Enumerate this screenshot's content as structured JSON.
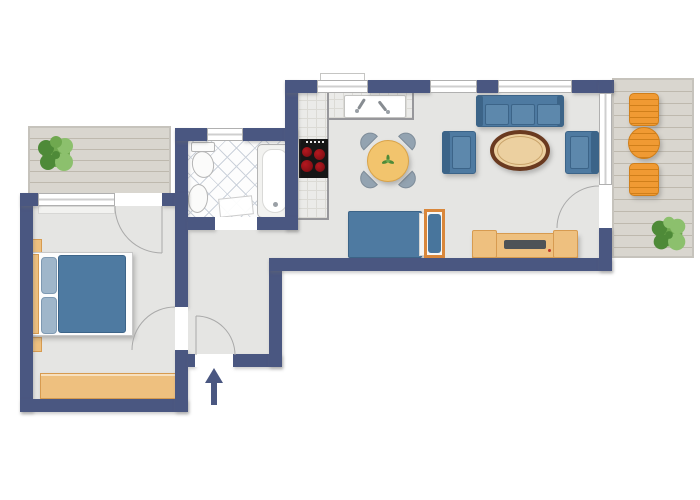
{
  "canvas": {
    "width": 700,
    "height": 500,
    "background": "#ffffff",
    "type": "apartment-floor-plan",
    "text_labels": []
  },
  "colors": {
    "wall": "#4a5781",
    "floor": "#e5e5e3",
    "tileBg": "#fdfdfd",
    "tileLine": "#ccd2db",
    "counter": "#ebebe9",
    "counterLine": "#dbdad5",
    "counterEdge": "#97979b",
    "deck": "#d9d6cf",
    "deckLine": "#beb9ae",
    "deckBorder": "#c6c3bc",
    "wood": "#eec07f",
    "woodEdge": "#d79b50",
    "frameOrange": "#d9873b",
    "blue": "#4e7aa1",
    "blueDark": "#3c6488",
    "cushion": "#5d88ac",
    "pillow": "#9fb6ca",
    "pillowDark": "#48759c",
    "orange": "#f09a33",
    "orangeDark": "#d07f1a",
    "stove": "#161616",
    "burner": "#8a1016",
    "outline": "#a9a9a9",
    "winFrame": "#b0b0b0",
    "winLine": "#cfcfcf",
    "white": "#ffffff",
    "fixture": "#fbfbfa",
    "fixtureEdge": "#b5b5b5",
    "plant1": "#4e8a38",
    "plant2": "#6fa84f",
    "plant3": "#8cc06d",
    "tableYellow": "#f2c46d",
    "tableYellowEdge": "#d9a348",
    "chairGray": "#93a3b1",
    "chairGrayEdge": "#7e8c99",
    "tableRim": "#6a3a20",
    "tableWood": "#ecd0a0",
    "tv": "#4e5357",
    "red": "#c0392b"
  },
  "rooms": [
    {
      "id": "balcony-left",
      "features": [
        "wood-deck",
        "potted-plant"
      ]
    },
    {
      "id": "bedroom",
      "features": [
        "double-bed",
        "two-pillows",
        "wardrobe",
        "window",
        "balcony-door",
        "hall-door"
      ]
    },
    {
      "id": "bathroom",
      "features": [
        "toilet",
        "washbasin",
        "bathtub",
        "window",
        "diagonal-tile-floor",
        "door"
      ]
    },
    {
      "id": "hall",
      "features": [
        "entrance-door",
        "entry-direction-arrow"
      ]
    },
    {
      "id": "living-room-kitchen",
      "features": [
        "kitchen-counter-L",
        "kitchen-sink",
        "stove-4-burners",
        "dining-table-round",
        "four-dining-chairs",
        "sofa-3-seat",
        "armchair-left",
        "armchair-right",
        "coffee-table-oval",
        "daybed",
        "sideboard-with-tv",
        "window-kitchen",
        "window-1",
        "window-2",
        "balcony-window",
        "balcony-door"
      ]
    },
    {
      "id": "balcony-right",
      "features": [
        "wood-deck",
        "chair-top",
        "round-table",
        "chair-bottom",
        "potted-plant"
      ]
    }
  ]
}
